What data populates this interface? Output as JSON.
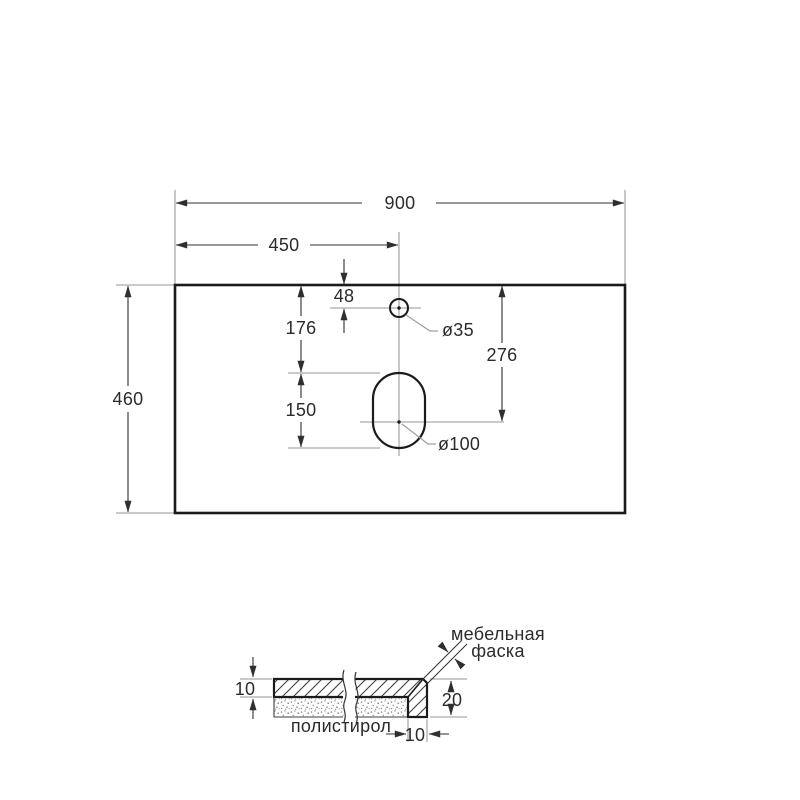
{
  "top_view": {
    "dim_width": "900",
    "dim_center_offset": "450",
    "dim_depth": "460",
    "dim_faucet_offset": "48",
    "dim_faucet_to_slot": "176",
    "dim_slot_length": "150",
    "dim_drain_center": "276",
    "label_faucet_diameter": "ø35",
    "label_drain_diameter": "ø100"
  },
  "section_view": {
    "dim_panel_thickness": "10",
    "dim_edge_height": "20",
    "dim_edge_width": "10",
    "label_chamfer_line1": "мебельная",
    "label_chamfer_line2": "фаска",
    "label_filler": "полистирол"
  },
  "colors": {
    "outline": "#1b1b1b",
    "dimension": "#2f2f2f",
    "construction": "#ababab",
    "background": "#ffffff"
  }
}
